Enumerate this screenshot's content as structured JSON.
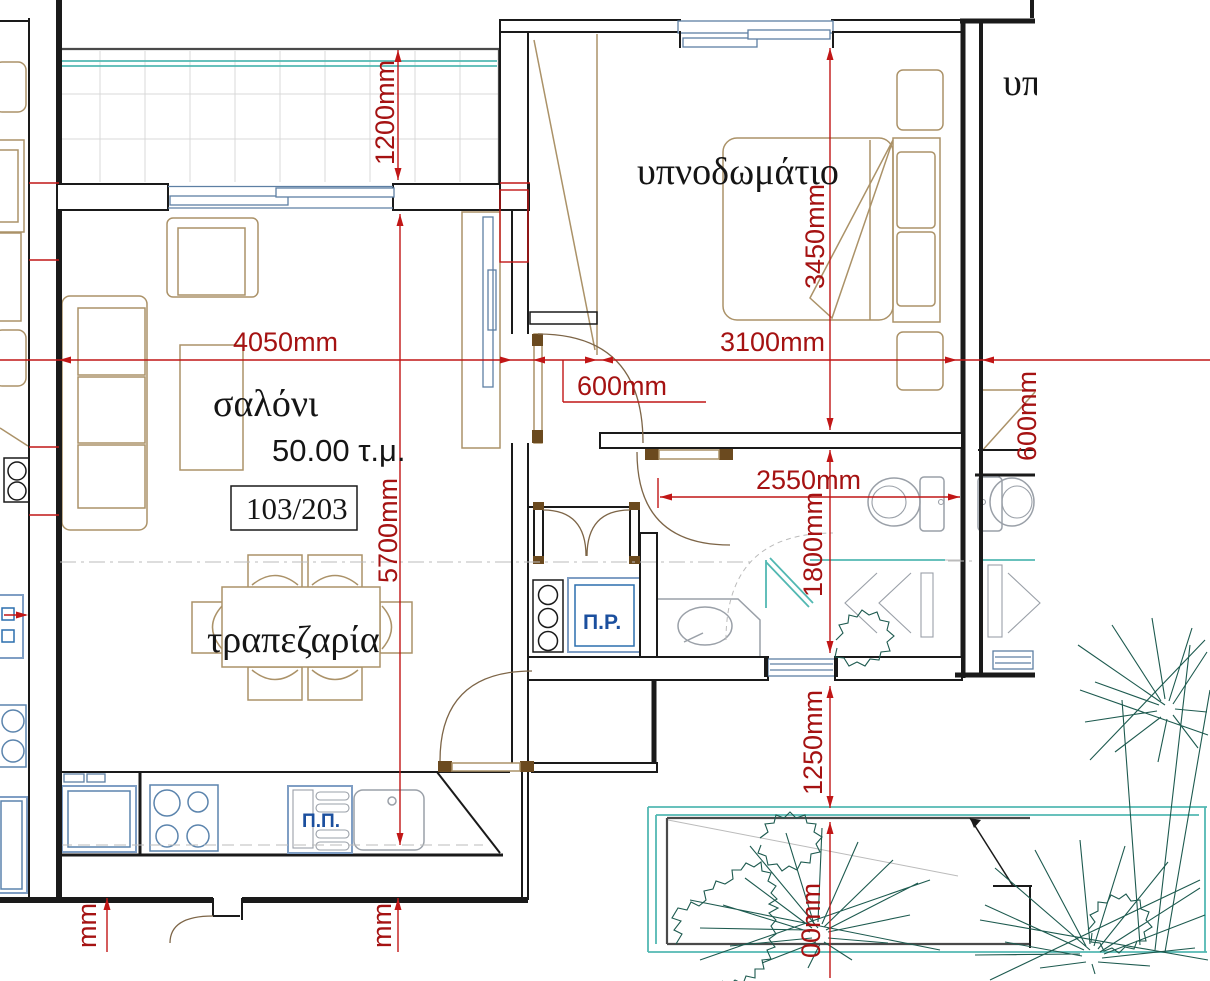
{
  "plan": {
    "unit_label": "103/203",
    "area_label": "50.00 τ.μ."
  },
  "rooms": {
    "living": "σαλόνι",
    "dining": "τραπεζαρία",
    "bedroom": "υπνοδωμάτιο",
    "neighbor_partial": "υπ"
  },
  "labels": {
    "laundry": "Π.Ρ.",
    "dishwasher": "Π.Π."
  },
  "dimensions": {
    "balcony_depth": "1200mm",
    "living_width": "4050mm",
    "living_length": "5700mm",
    "bedroom_width": "3100mm",
    "bedroom_length": "3450mm",
    "door_width": "600mm",
    "hall_width": "2550mm",
    "bath_length": "1800mm",
    "terrace_offset": "1250mm",
    "terrace_partial": "00mm",
    "neighbor_door": "600mm",
    "partial_left": "mm",
    "partial_mid": "mm"
  },
  "colors": {
    "wall": "#1a1a1a",
    "dimension_line": "#c11616",
    "dimension_text": "#a51212",
    "furniture": "#ab9268",
    "door_arc": "#7d6547",
    "fixture": "#9aa0a8",
    "window": "#5d7fa3",
    "appliance_frame": "#7f9ec4",
    "appliance_text": "#1b4f9e",
    "railing_teal": "#52b8b2",
    "plant_green": "#1d5a4f",
    "tile_grid": "#d9d9d9"
  }
}
